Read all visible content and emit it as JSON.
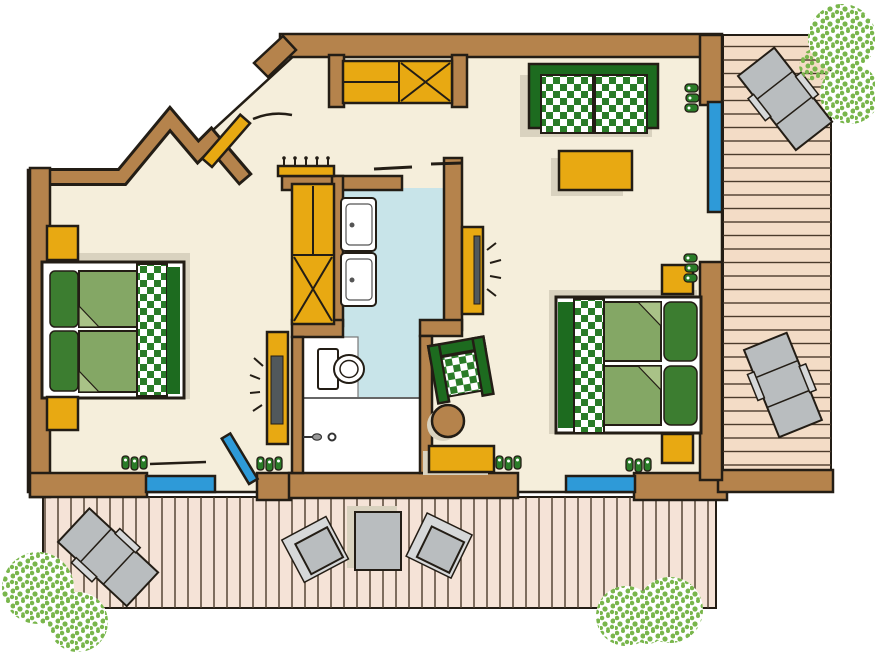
{
  "meta": {
    "kind": "floor-plan-illustration",
    "style": "hand-drawn top-down color plan of a two-bedroom suite with bathroom and wooden decks",
    "text_on_image": "none"
  },
  "colors": {
    "background": "#ffffff",
    "wall": "#b5834c",
    "outline": "#231d15",
    "floor": "#f5eedb",
    "bath": "#c8e4e9",
    "yellow": "#e8a912",
    "green_dark": "#1d6b1f",
    "checker_green": "#2a7c28",
    "duvet": "#84a765",
    "pillow": "#3c7d30",
    "fold": "#a9c287",
    "deck_bottom": "#f5e3d7",
    "deck_right": "#f3dcc6",
    "plank": "#4a3a2a",
    "gray": "#b9bdbf",
    "gray_light": "#d6d8d9",
    "shadow": "#d9d2bf",
    "bush": "#79b64c",
    "glass": "#2e9ad8",
    "screen": "#51585c"
  },
  "plan": {
    "rooms": [
      {
        "name": "bedroom-left",
        "furniture": [
          "double-bed-green-checkered-runner",
          "nightstand",
          "nightstand",
          "wall-tv",
          "slippers",
          "slippers"
        ]
      },
      {
        "name": "entrance-hall",
        "furniture": [
          "built-in-wardrobe-shelf-and-x",
          "coat-rack-hooks",
          "open-entrance-door"
        ]
      },
      {
        "name": "bathroom",
        "furniture": [
          "washbasin",
          "washbasin",
          "toilet",
          "shower",
          "niche-cabinet"
        ]
      },
      {
        "name": "living-bedroom-right",
        "furniture": [
          "checkered-sofa",
          "coffee-table",
          "double-bed-green-checkered-runner",
          "nightstand",
          "nightstand",
          "armchair-checkered",
          "round-side-table",
          "bench",
          "wall-tv",
          "slippers",
          "slippers",
          "slippers"
        ]
      },
      {
        "name": "deck-bottom",
        "furniture": [
          "sun-lounger",
          "bistro-table",
          "deck-chair",
          "deck-chair"
        ]
      },
      {
        "name": "deck-right",
        "furniture": [
          "sun-lounger",
          "sun-lounger"
        ]
      }
    ],
    "openings": [
      "entrance-door-top-left",
      "glass-door-left-room-south",
      "glass-door-right-room-south",
      "glass-door-east-wall",
      "bathroom-sliding-door"
    ],
    "landscape": [
      "bush-top-right",
      "bush-bottom-left",
      "bush-bottom-center"
    ]
  }
}
